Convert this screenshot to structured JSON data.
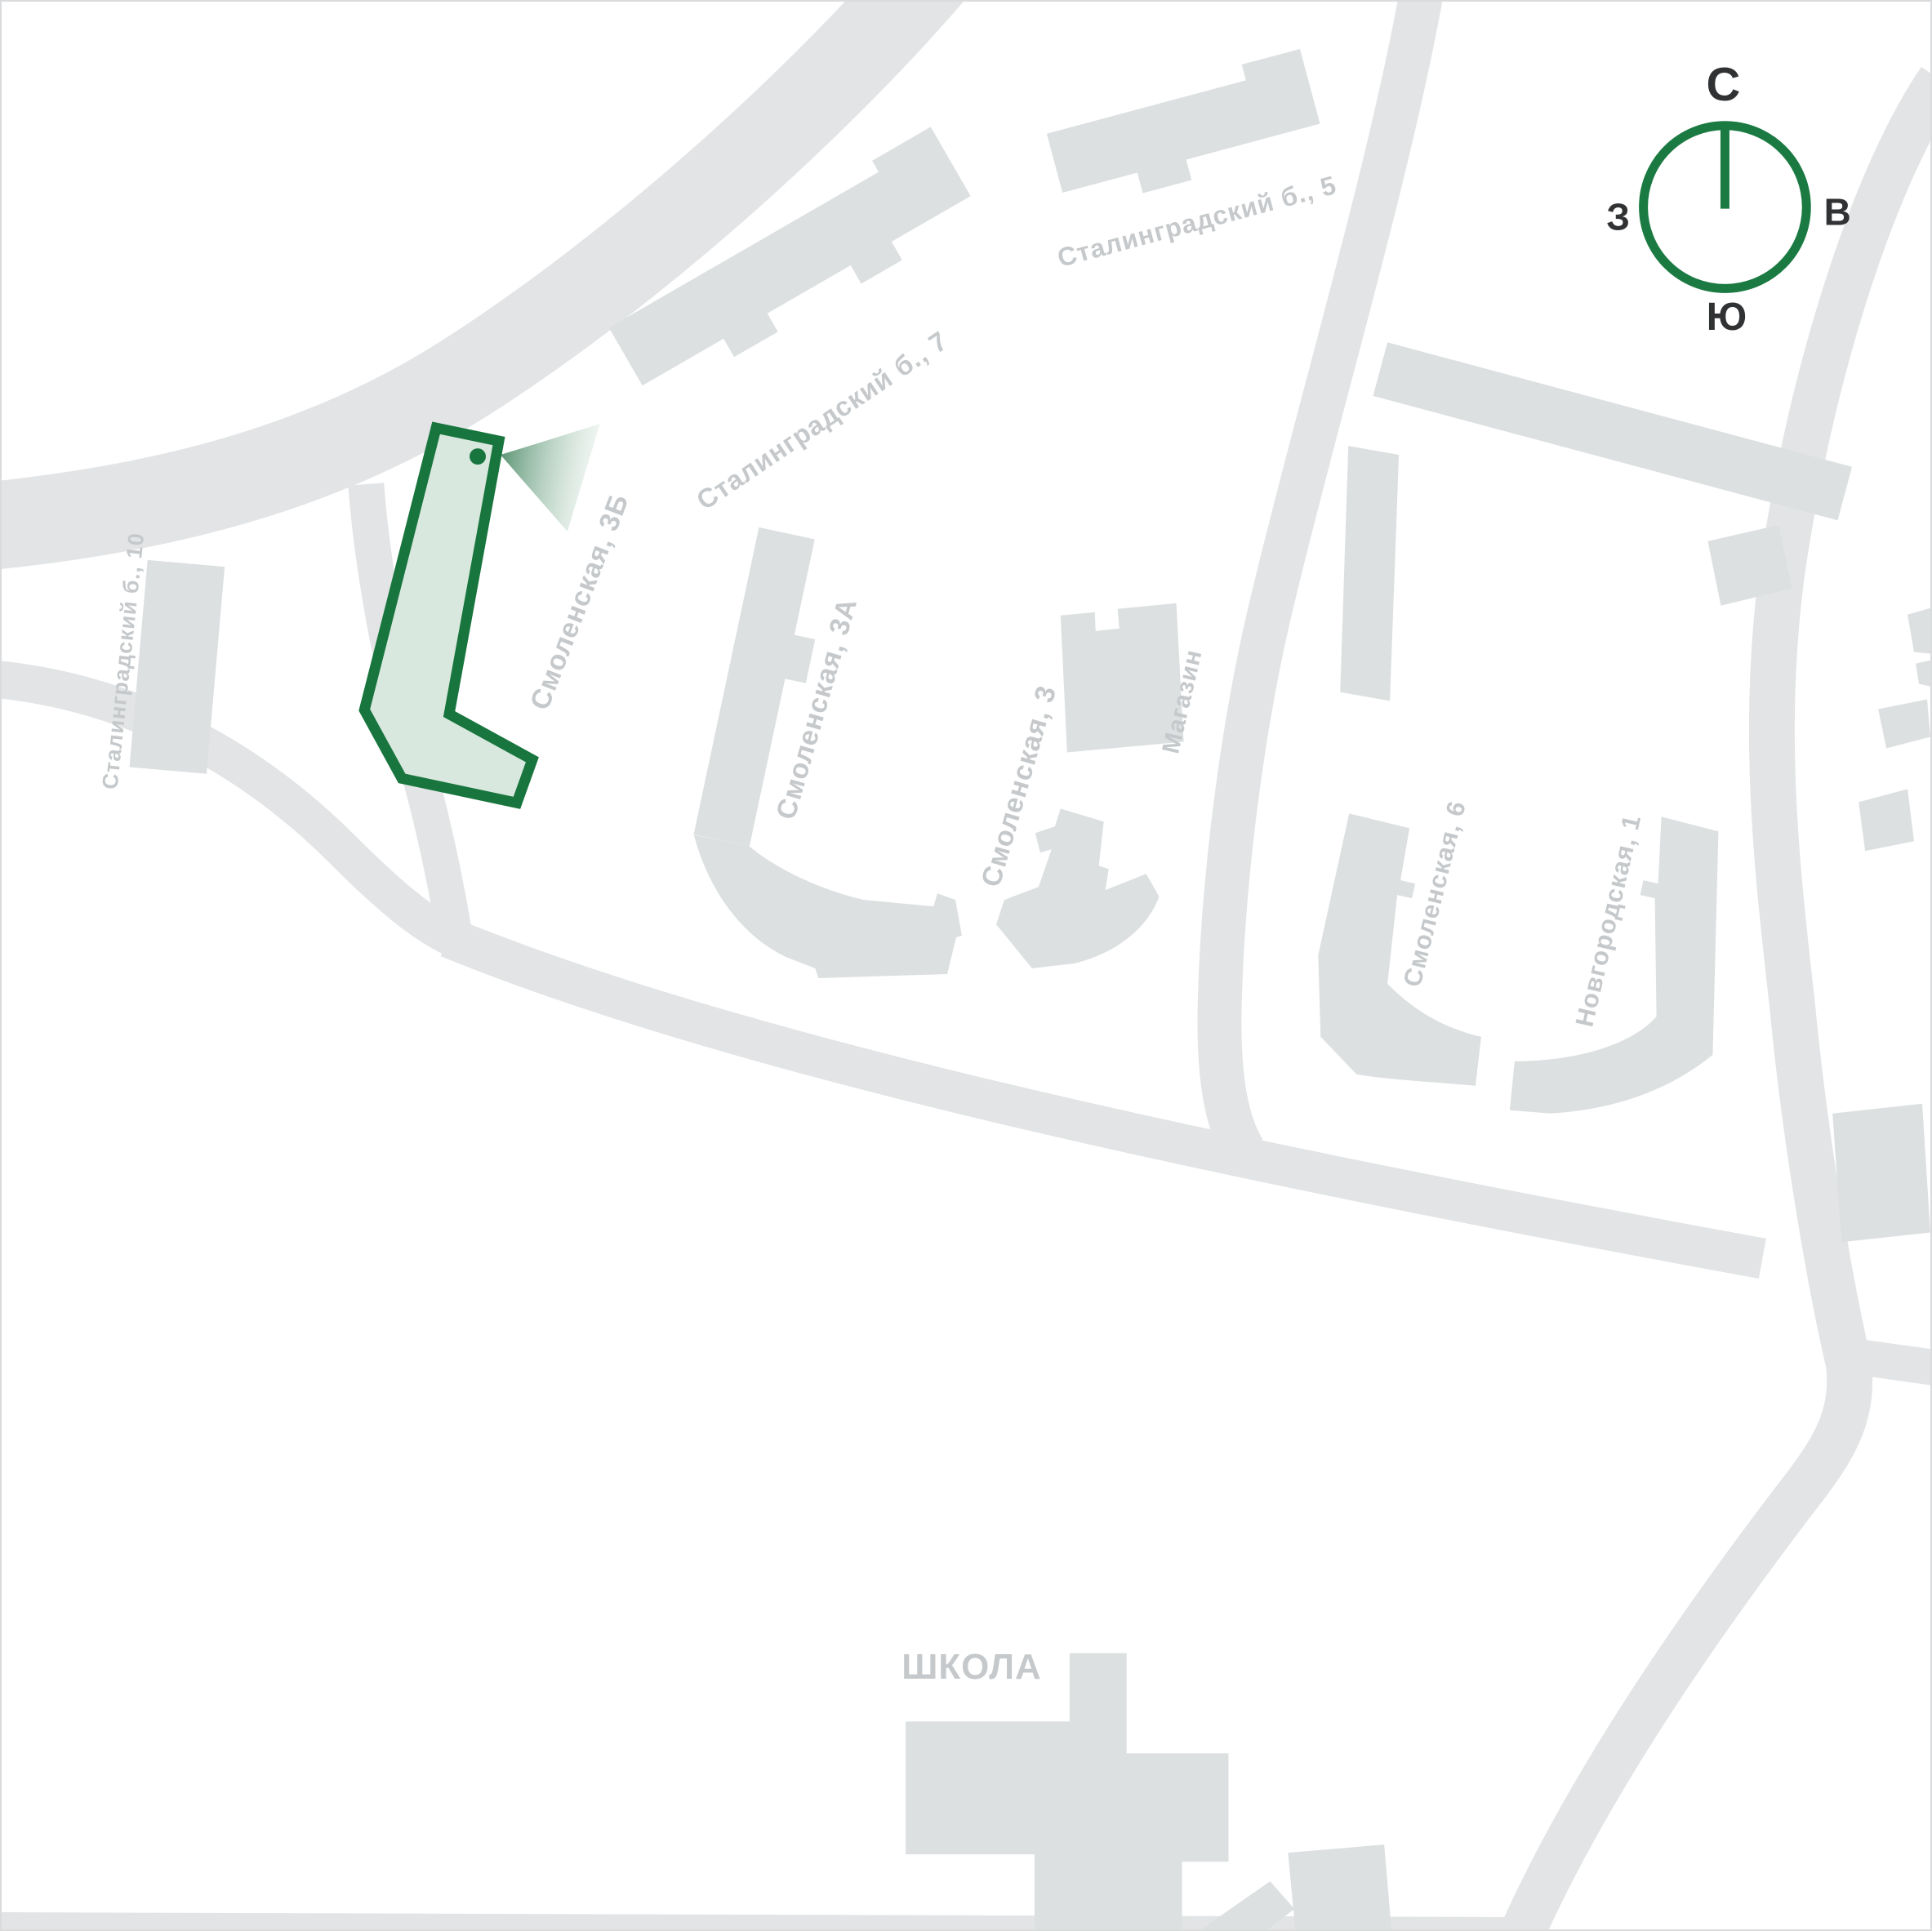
{
  "page": {
    "background": "#ffffff",
    "frame_color": "#d9dbdc"
  },
  "palette": {
    "road": "#e2e4e5",
    "building": "#dde0e1",
    "label_gray": "#c6c9cb",
    "accent_green": "#18753e",
    "accent_green_fill": "#d9e8de",
    "compass_letter_dark": "#303234"
  },
  "map": {
    "type": "site-plan",
    "highlighted_building": {
      "label": "Смоленская, 3Б",
      "outline_color": "#18753e",
      "fill_color": "#d9e8de"
    },
    "labels": {
      "stalingradsky_7": "Сталинградский б., 7",
      "stalingradsky_5": "Сталинградский б., 5",
      "stalingradsky_10": "Сталинградский б., 10",
      "smolenskaya_3b": "Смоленская, 3Б",
      "smolenskaya_3a": "Смоленская, 3А",
      "smolenskaya_3": "Смоленская, 3",
      "magazin": "Магазин",
      "smolenskaya_6": "Смоленская, 6",
      "novgorodskaya_1": "Новгородская, 1",
      "school": "ШКОЛА"
    }
  },
  "compass": {
    "north": "С",
    "east": "В",
    "south": "Ю",
    "west": "З",
    "ring_color": "#1b7a42"
  }
}
